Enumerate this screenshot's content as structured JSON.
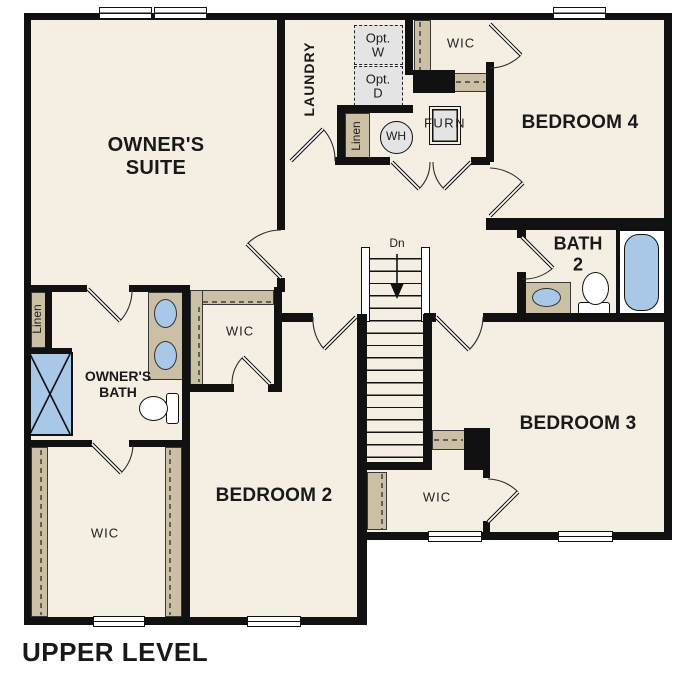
{
  "title": "UPPER LEVEL",
  "colors": {
    "floor": "#f5eee2",
    "wall": "#111111",
    "casework": "#cbc0a6",
    "appliance": "#e4e4e4",
    "fixture": "#a9c7e7"
  },
  "rooms": {
    "owners_suite": {
      "line1": "OWNER'S",
      "line2": "SUITE"
    },
    "laundry": {
      "label": "LAUNDRY"
    },
    "bedroom4": {
      "label": "BEDROOM 4"
    },
    "bath2": {
      "line1": "BATH",
      "line2": "2"
    },
    "owners_bath": {
      "line1": "OWNER'S",
      "line2": "BATH"
    },
    "bedroom2": {
      "label": "BEDROOM 2"
    },
    "bedroom3": {
      "label": "BEDROOM 3"
    },
    "wic_bedroom4": {
      "label": "WIC"
    },
    "wic_bedroom2": {
      "label": "WIC"
    },
    "wic_owners": {
      "label": "WIC"
    },
    "wic_bedroom3": {
      "label": "WIC"
    }
  },
  "closets": {
    "linen_laundry": "Linen",
    "linen_owners": "Linen"
  },
  "appliances": {
    "washer_optional": {
      "line1": "Opt.",
      "line2": "W"
    },
    "dryer_optional": {
      "line1": "Opt.",
      "line2": "D"
    },
    "water_heater": "WH",
    "furnace": "FURN"
  },
  "stairs": {
    "down_label": "Dn"
  }
}
